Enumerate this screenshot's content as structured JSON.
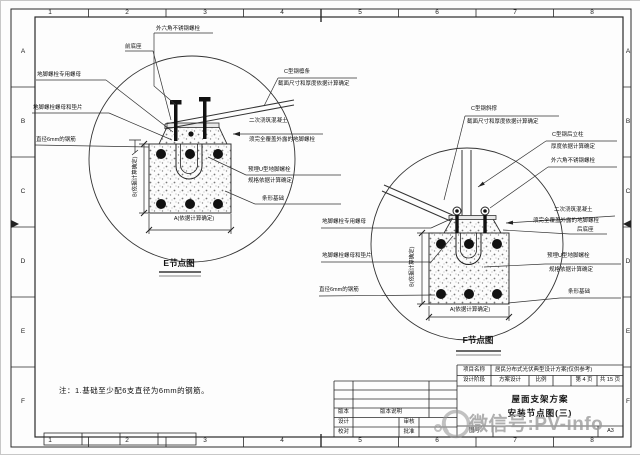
{
  "frame": {
    "columns": [
      "1",
      "2",
      "3",
      "4",
      "5",
      "6",
      "7",
      "8"
    ],
    "rows": [
      "A",
      "B",
      "C",
      "D",
      "E",
      "F"
    ]
  },
  "detail_e": {
    "title": "E节点图",
    "labels": {
      "hex_bolt": "外六角不锈钢螺栓",
      "base_front": "前底座",
      "nut_special": "地脚螺栓专用螺母",
      "nut_washer": "地脚螺栓螺母和垫片",
      "rebar": "直径6mm的钢筋",
      "purlin": "C型钢檩条",
      "purlin_note": "截面尺寸和厚度依据计算确定",
      "secondary_concrete": "二次浇筑混凝土",
      "secondary_concrete_note": "须完全覆盖外露的地脚螺栓",
      "u_bolt": "预埋U型地脚螺栓",
      "u_bolt_note": "规格依据计算确定",
      "strip_foundation": "条形基础",
      "dim_a": "A(依据计算确定)",
      "dim_b": "B(依据计算确定)"
    }
  },
  "detail_f": {
    "title": "F节点图",
    "labels": {
      "brace": "C型钢斜撑",
      "brace_note": "截面尺寸和厚度依据计算确定",
      "rear_column": "C型钢后立柱",
      "rear_column_note": "厚度依据计算确定",
      "hex_bolt": "外六角不锈钢螺栓",
      "secondary_concrete": "二次浇筑混凝土",
      "secondary_concrete_note": "须完全覆盖外露的地脚螺栓",
      "base_rear": "后底座",
      "nut_special": "地脚螺栓专用螺母",
      "nut_washer": "地脚螺栓螺母和垫片",
      "rebar": "直径6mm的钢筋",
      "u_bolt": "预埋U型地脚螺栓",
      "u_bolt_note": "规格依据计算确定",
      "strip_foundation": "条形基础",
      "dim_a": "A(依据计算确定)",
      "dim_b": "B(依据计算确定)"
    }
  },
  "note": "注：1.基础至少配6支直径为6mm的钢筋。",
  "title_block": {
    "project_label": "项目名称",
    "project_value": "居民分布式光伏典型设计方案(仅供参考)",
    "stage_label": "设计阶段",
    "stage_value": "方案设计",
    "scale_label": "比例",
    "page_label": "第 4 页",
    "pages_label": "共 15 页",
    "drawing_title_1": "屋面支架方案",
    "drawing_title_2": "安装节点图(三)",
    "version_label": "版本",
    "version_desc_label": "版本说明",
    "design_label": "设计",
    "review_label": "审核",
    "check_label": "校对",
    "approve_label": "批准",
    "drawing_no_label": "图号",
    "sheet_size": "A3"
  },
  "watermark": {
    "text": "微信号:PV-info"
  }
}
